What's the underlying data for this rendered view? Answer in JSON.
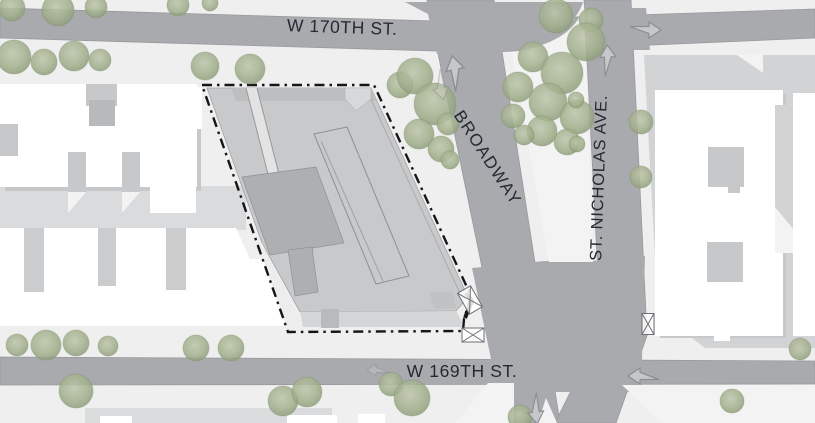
{
  "map": {
    "street_labels": {
      "w170th": "W 170TH ST.",
      "broadway": "BROADWAY",
      "st_nicholas": "ST. NICHOLAS AVE.",
      "w169th": "W 169TH ST."
    },
    "colors": {
      "ground": "#efeff0",
      "street": "#a9aaae",
      "street_edge": "#98999c",
      "sidewalk": "#f3f3f4",
      "block_shade": "#dadbdd",
      "east_block": "#d2d3d5",
      "building": "#ffffff",
      "building_shadow": "#c7c8ca",
      "site_mass": "#c8c9cb",
      "site_mass_dark": "#aeafb1",
      "site_mass_medium": "#bdbec0",
      "boundary": "#161616",
      "tree_fill": "#a5b18f",
      "tree_edge": "#7e8e6d",
      "arrow_fill": "#d9dadc",
      "arrow_edge": "#8d8e91",
      "label_text": "#262833"
    },
    "site_boundary_style": "dash-dot",
    "trees": [
      [
        12,
        8,
        13
      ],
      [
        58,
        10,
        16
      ],
      [
        96,
        7,
        11
      ],
      [
        178,
        5,
        11
      ],
      [
        210,
        3,
        8
      ],
      [
        14,
        57,
        17
      ],
      [
        44,
        62,
        13
      ],
      [
        74,
        56,
        15
      ],
      [
        100,
        60,
        11
      ],
      [
        205,
        66,
        14
      ],
      [
        250,
        69,
        15
      ],
      [
        400,
        85,
        13
      ],
      [
        415,
        76,
        18
      ],
      [
        435,
        104,
        21
      ],
      [
        419,
        134,
        15
      ],
      [
        441,
        149,
        13
      ],
      [
        448,
        124,
        11
      ],
      [
        450,
        160,
        9
      ],
      [
        556,
        16,
        17
      ],
      [
        591,
        20,
        12
      ],
      [
        586,
        42,
        19
      ],
      [
        533,
        57,
        15
      ],
      [
        562,
        73,
        21
      ],
      [
        518,
        87,
        15
      ],
      [
        548,
        102,
        19
      ],
      [
        577,
        117,
        17
      ],
      [
        542,
        131,
        15
      ],
      [
        513,
        116,
        12
      ],
      [
        567,
        142,
        13
      ],
      [
        524,
        135,
        10
      ],
      [
        576,
        100,
        8
      ],
      [
        577,
        144,
        8
      ],
      [
        641,
        122,
        12
      ],
      [
        641,
        177,
        11
      ],
      [
        17,
        345,
        11
      ],
      [
        46,
        345,
        15
      ],
      [
        76,
        343,
        13
      ],
      [
        108,
        346,
        10
      ],
      [
        196,
        348,
        13
      ],
      [
        231,
        348,
        13
      ],
      [
        76,
        391,
        17
      ],
      [
        283,
        401,
        15
      ],
      [
        307,
        392,
        15
      ],
      [
        391,
        384,
        12
      ],
      [
        412,
        398,
        18
      ],
      [
        520,
        417,
        12
      ],
      [
        732,
        401,
        12
      ],
      [
        800,
        349,
        11
      ]
    ],
    "arrows": [
      {
        "x": 645,
        "y": 30,
        "dir": "right",
        "scale": 1
      },
      {
        "x": 608,
        "y": 61,
        "dir": "up",
        "scale": 1,
        "tilt": -3
      },
      {
        "x": 456,
        "y": 74,
        "dir": "up",
        "tilt": -12,
        "scale": 1.15
      },
      {
        "x": 440,
        "y": 84,
        "dir": "down",
        "tilt": -12,
        "scale": 1,
        "faint": true
      },
      {
        "x": 379,
        "y": 370,
        "dir": "left",
        "scale": 0.75,
        "faint": true
      },
      {
        "x": 644,
        "y": 376,
        "dir": "left",
        "scale": 1
      },
      {
        "x": 535,
        "y": 408,
        "dir": "down",
        "tilt": -8,
        "scale": 1
      }
    ]
  }
}
